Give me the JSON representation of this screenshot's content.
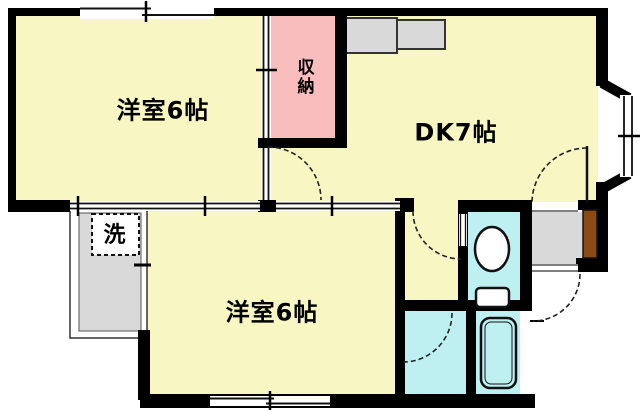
{
  "plan": {
    "type": "floor-plan",
    "rooms": {
      "western_room_1": {
        "label": "洋室6帖"
      },
      "dining_kitchen": {
        "label": "DK7帖"
      },
      "western_room_2": {
        "label": "洋室6帖"
      },
      "closet": {
        "label": "収納"
      },
      "laundry": {
        "label": "洗"
      }
    },
    "colors": {
      "room_yellow": "#F8F6C3",
      "closet_pink": "#F9BDBD",
      "wet_cyan": "#BEF0F2",
      "counter_gray": "#D9D9D9",
      "genkan_gray": "#D9D9D9",
      "door_brown": "#8C4B12",
      "wall_black": "#000000",
      "background": "#FFFFFF"
    }
  }
}
